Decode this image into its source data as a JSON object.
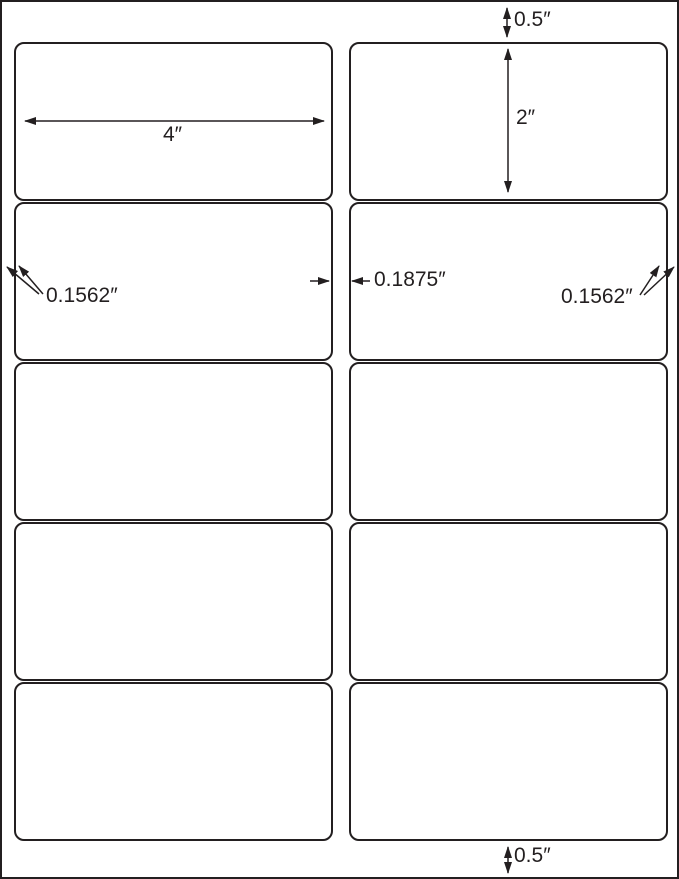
{
  "page": {
    "title": "Label sheet template diagram",
    "colors": {
      "line": "#231f20",
      "background": "#ffffff",
      "label_fill": "#ffffff"
    }
  },
  "grid": {
    "rows": 5,
    "columns": 2
  },
  "dimensions": {
    "top_margin": "0.5″",
    "label_width": "4″",
    "label_height": "2″",
    "left_margin": "0.1562″",
    "column_gap": "0.1875″",
    "right_margin": "0.1562″",
    "bottom_margin": "0.5″"
  }
}
